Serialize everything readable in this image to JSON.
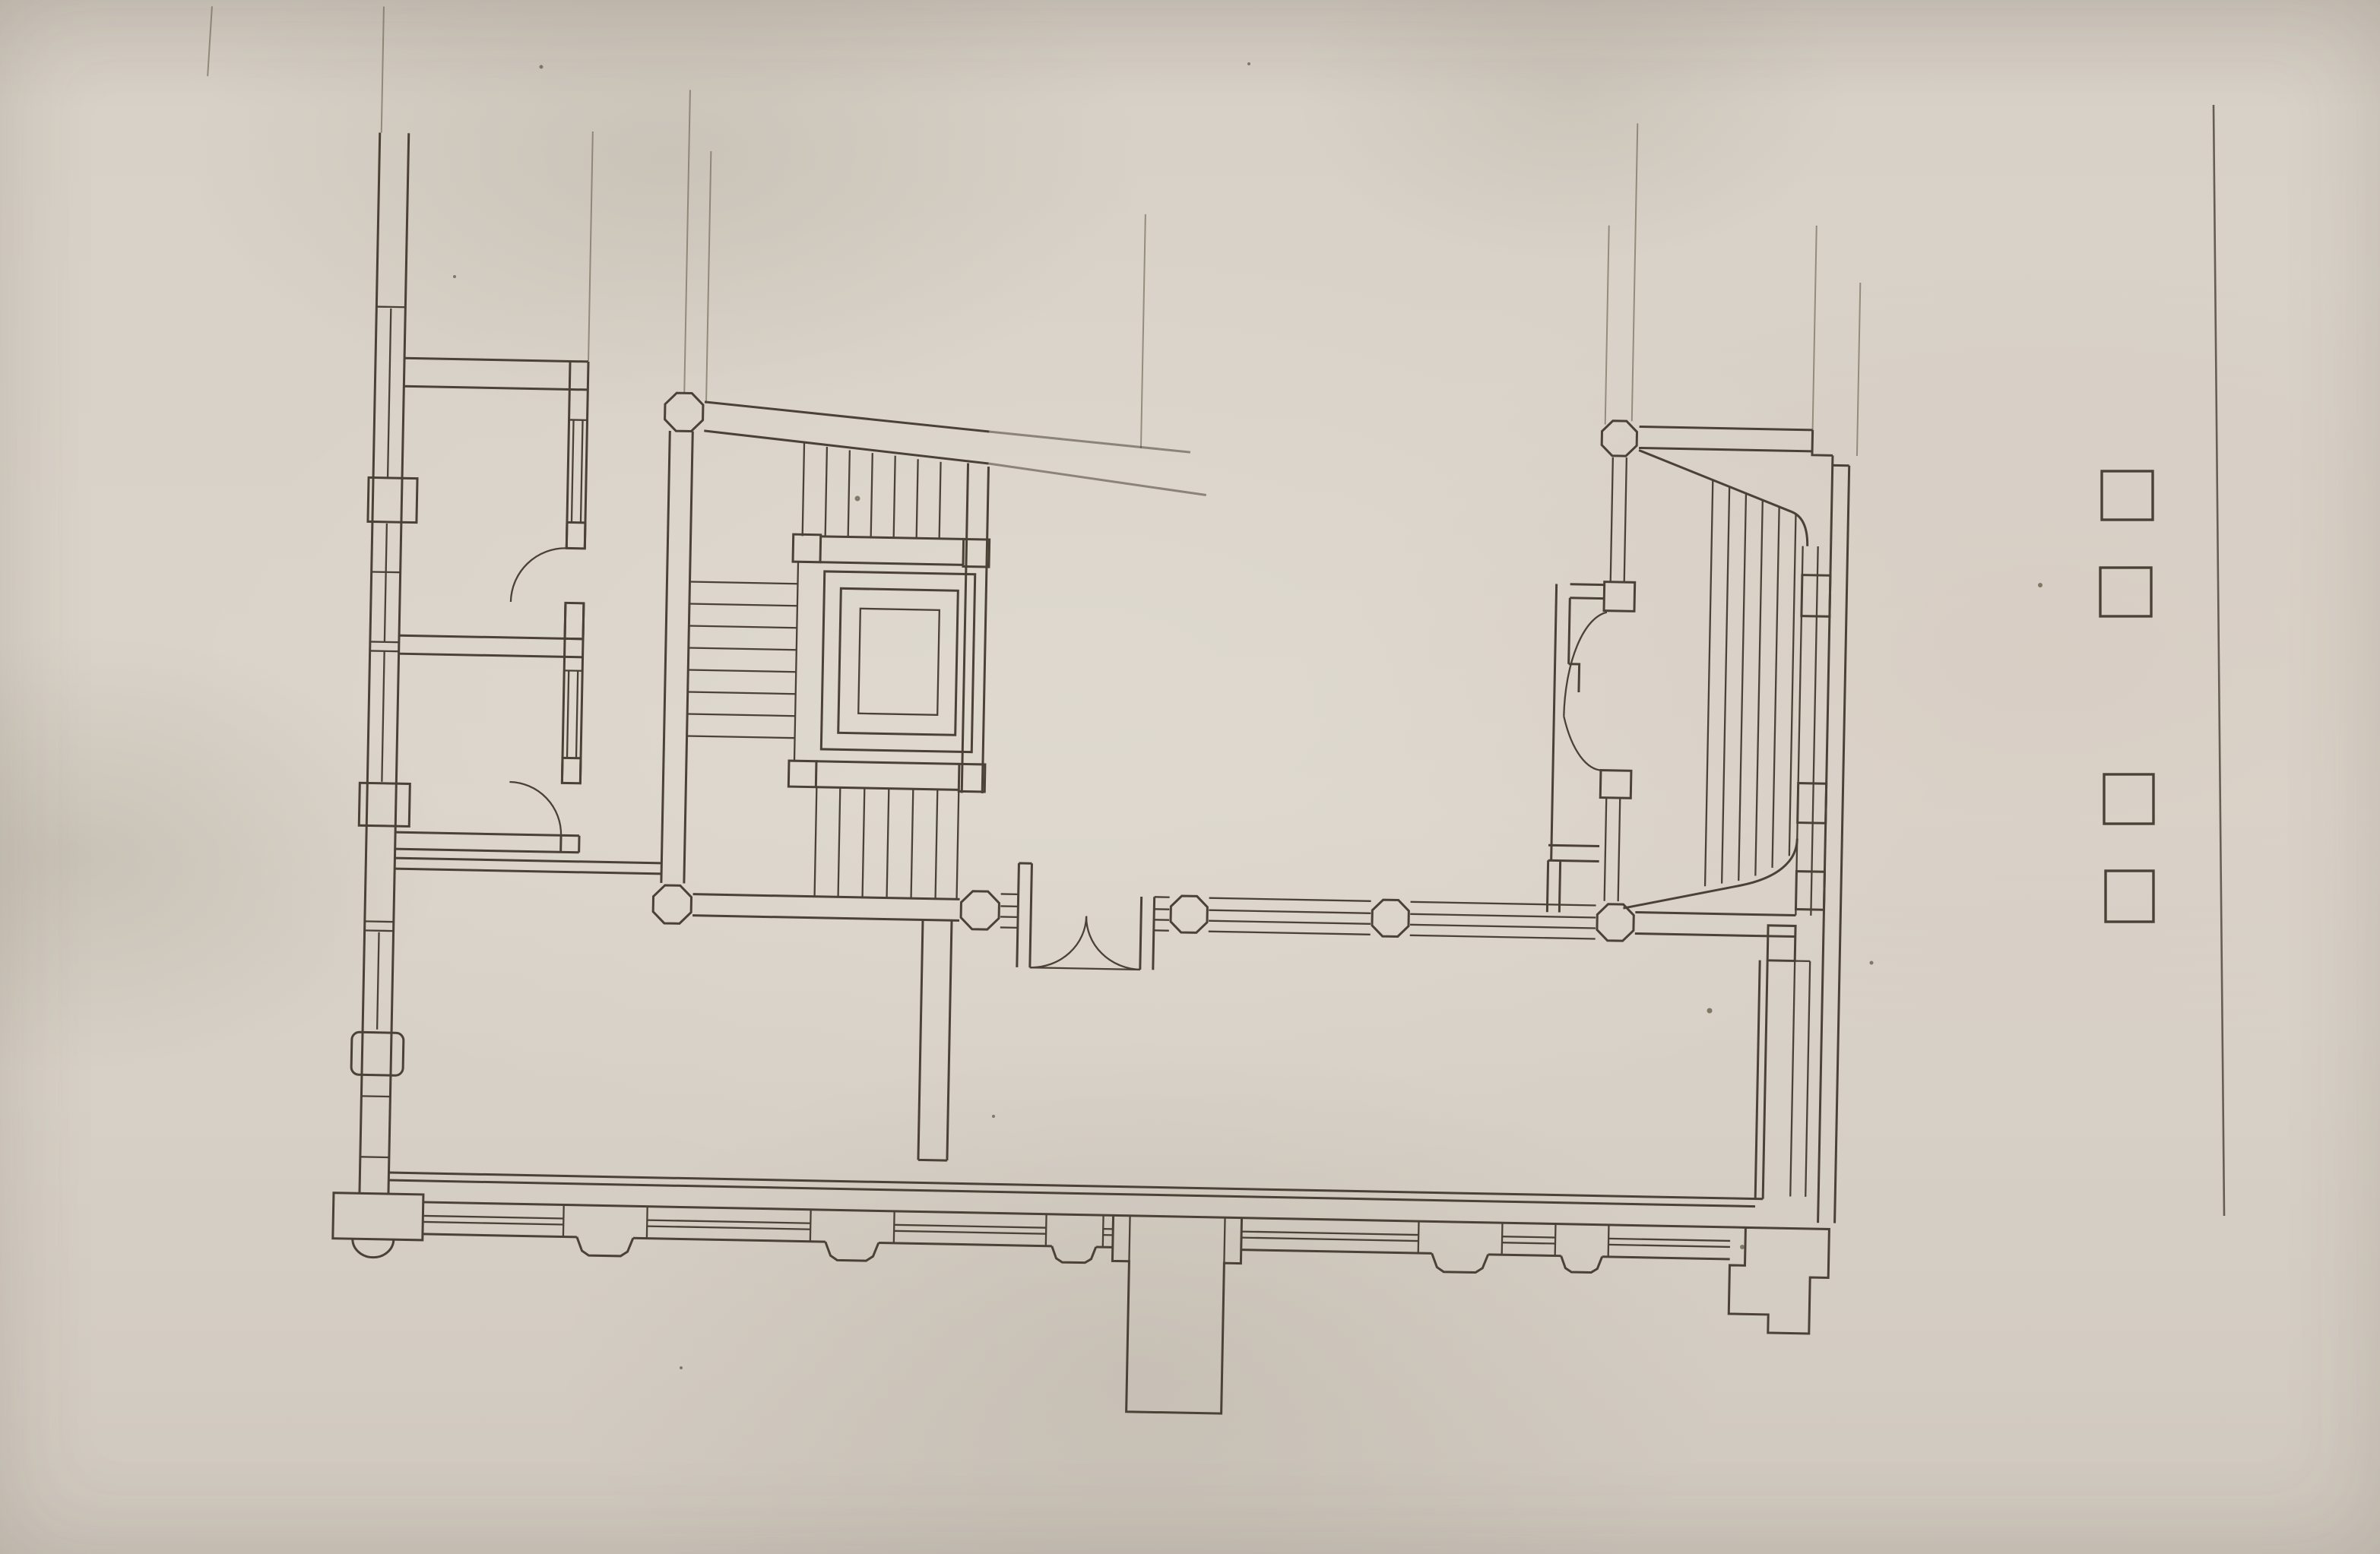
{
  "document": {
    "description": "Photograph of a hand-drafted architectural floor plan in ink on aged, slightly wrinkled paper; no text, dimensions or labels are visible.",
    "media": "ink line drawing on paper, photographed with a slight clockwise tilt"
  },
  "colors": {
    "paper": "#d8d1c7",
    "paper-shadow": "#c9c2b8",
    "ink": "#4b4136",
    "ink-faint": "#6b614f"
  },
  "drawing": {
    "left_wing": {
      "rooms": 3,
      "doors_with_quarter_circle_swing": 2,
      "exterior_wall_window_segments": 4,
      "wall_pilaster_blocks": 3
    },
    "central_staircase": {
      "flights": 3,
      "octagonal_newel_columns": 2,
      "square_newel_blocks": 4,
      "elevator_shaft_rings": 3
    },
    "south_window_band": {
      "octagonal_columns": 4,
      "double_swing_door_leaves": 2
    },
    "right_staircase": {
      "octagonal_newel_columns": 2,
      "treads": 6,
      "double_swing_door_leaves": 2,
      "landing_blocks": 3
    },
    "south_colonnade": {
      "piers_with_bumped_bases": 5,
      "entrance_porch_pier": 1,
      "corner_piers": 2
    },
    "underlying_sheet": {
      "free_standing_column_squares": 4,
      "sheet_edge_lines": 1
    }
  }
}
